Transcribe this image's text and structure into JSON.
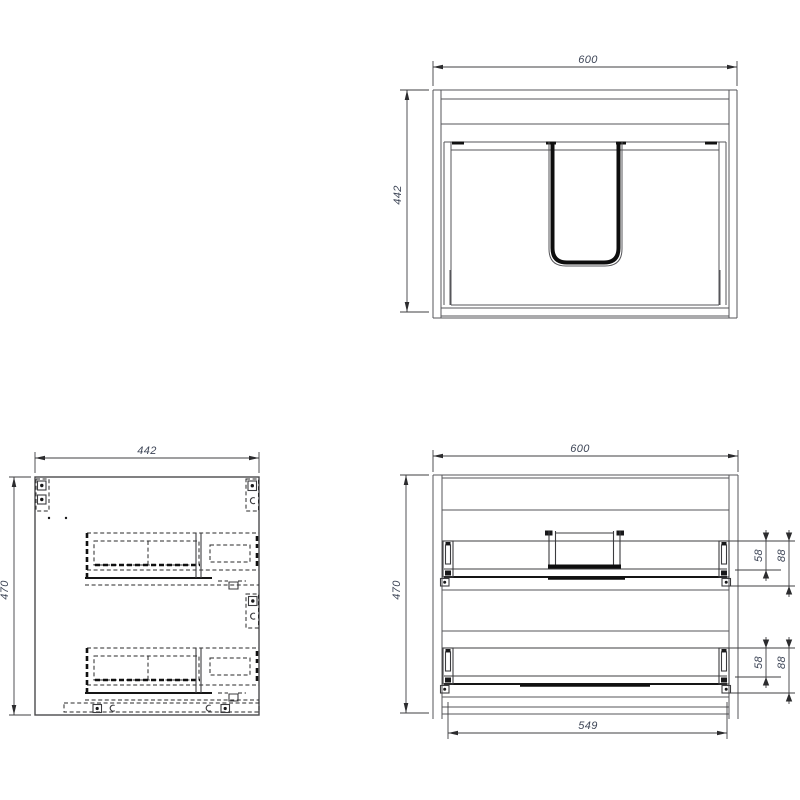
{
  "drawing": {
    "type": "furniture-technical-drawing",
    "views": {
      "front": {
        "width": "600",
        "height": "442"
      },
      "side": {
        "width": "442",
        "height": "470"
      },
      "internal_front": {
        "width": "600",
        "height": "470",
        "opening_width": "549",
        "rail_offset_small": "58",
        "rail_offset_large": "88"
      }
    },
    "colors": {
      "background": "#ffffff",
      "line": "#56565a",
      "dark_line": "#141414",
      "hidden_line": "#28282a",
      "dimension_text": "#3e4657"
    }
  }
}
